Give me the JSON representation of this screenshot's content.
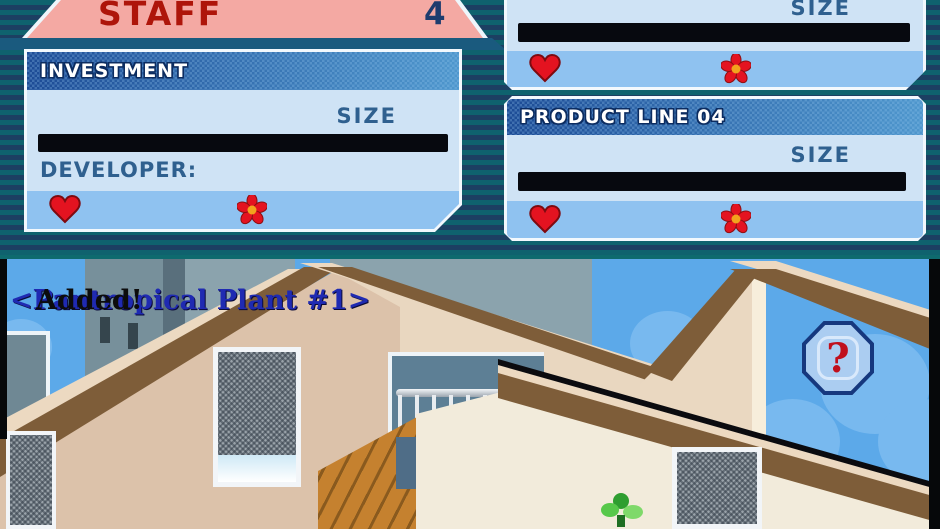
{
  "top_screen": {
    "staff_banner": {
      "label": "STAFF",
      "count": "4"
    },
    "investment_panel": {
      "header": "INVESTMENT",
      "size_label": "SIZE",
      "developer_label": "DEVELOPER:"
    },
    "product_line_03_panel": {
      "size_label": "SIZE"
    },
    "product_line_04_panel": {
      "header": "PRODUCT LINE 04",
      "size_label": "SIZE"
    }
  },
  "bottom_screen": {
    "message": {
      "item": "<Pantropical Plant #1>",
      "status": "Added!"
    },
    "help_button": {
      "label": "?"
    }
  },
  "colors": {
    "banner_pink": "#f4a9a3",
    "banner_text_red": "#ae150a",
    "header_blue": "#1d4c96",
    "panel_body_blue": "#cfe3f5",
    "panel_footer_blue": "#8fc2f0",
    "heart_red": "#e41320",
    "flower_center_orange": "#f2a31d",
    "sky_blue": "#5ca9e9",
    "stripe_teal": "#0f626e",
    "stripe_navy": "#1c3f62"
  }
}
